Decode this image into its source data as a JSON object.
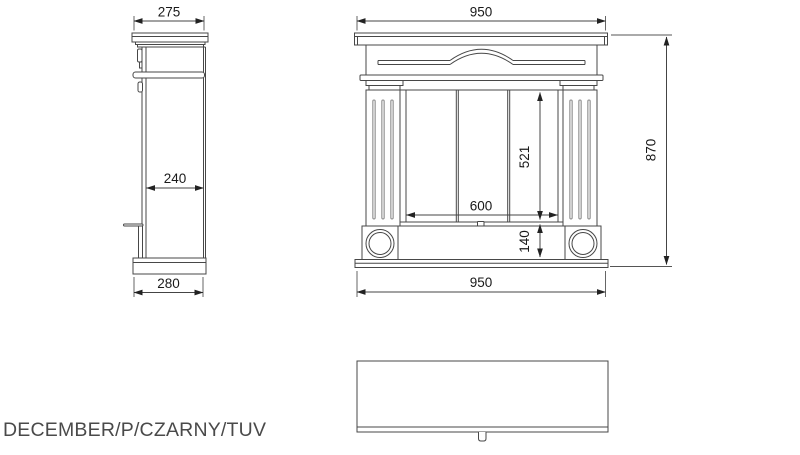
{
  "product_label": "DECEMBER/P/CZARNY/TUV",
  "views": {
    "side_view": {
      "top_depth": "275",
      "body_depth": "240",
      "base_depth": "280"
    },
    "front_view": {
      "top_width": "950",
      "opening_width": "600",
      "opening_height": "521",
      "plinth_height": "140",
      "base_width": "950",
      "total_height": "870"
    }
  },
  "colors": {
    "background": "#ffffff",
    "drawing_line": "#474747",
    "dimension_line": "#444444",
    "arrowhead": "#222222",
    "dimension_text": "#1a1a1a",
    "label_text": "#4a4a4a",
    "flute_fill": "#ededed"
  }
}
